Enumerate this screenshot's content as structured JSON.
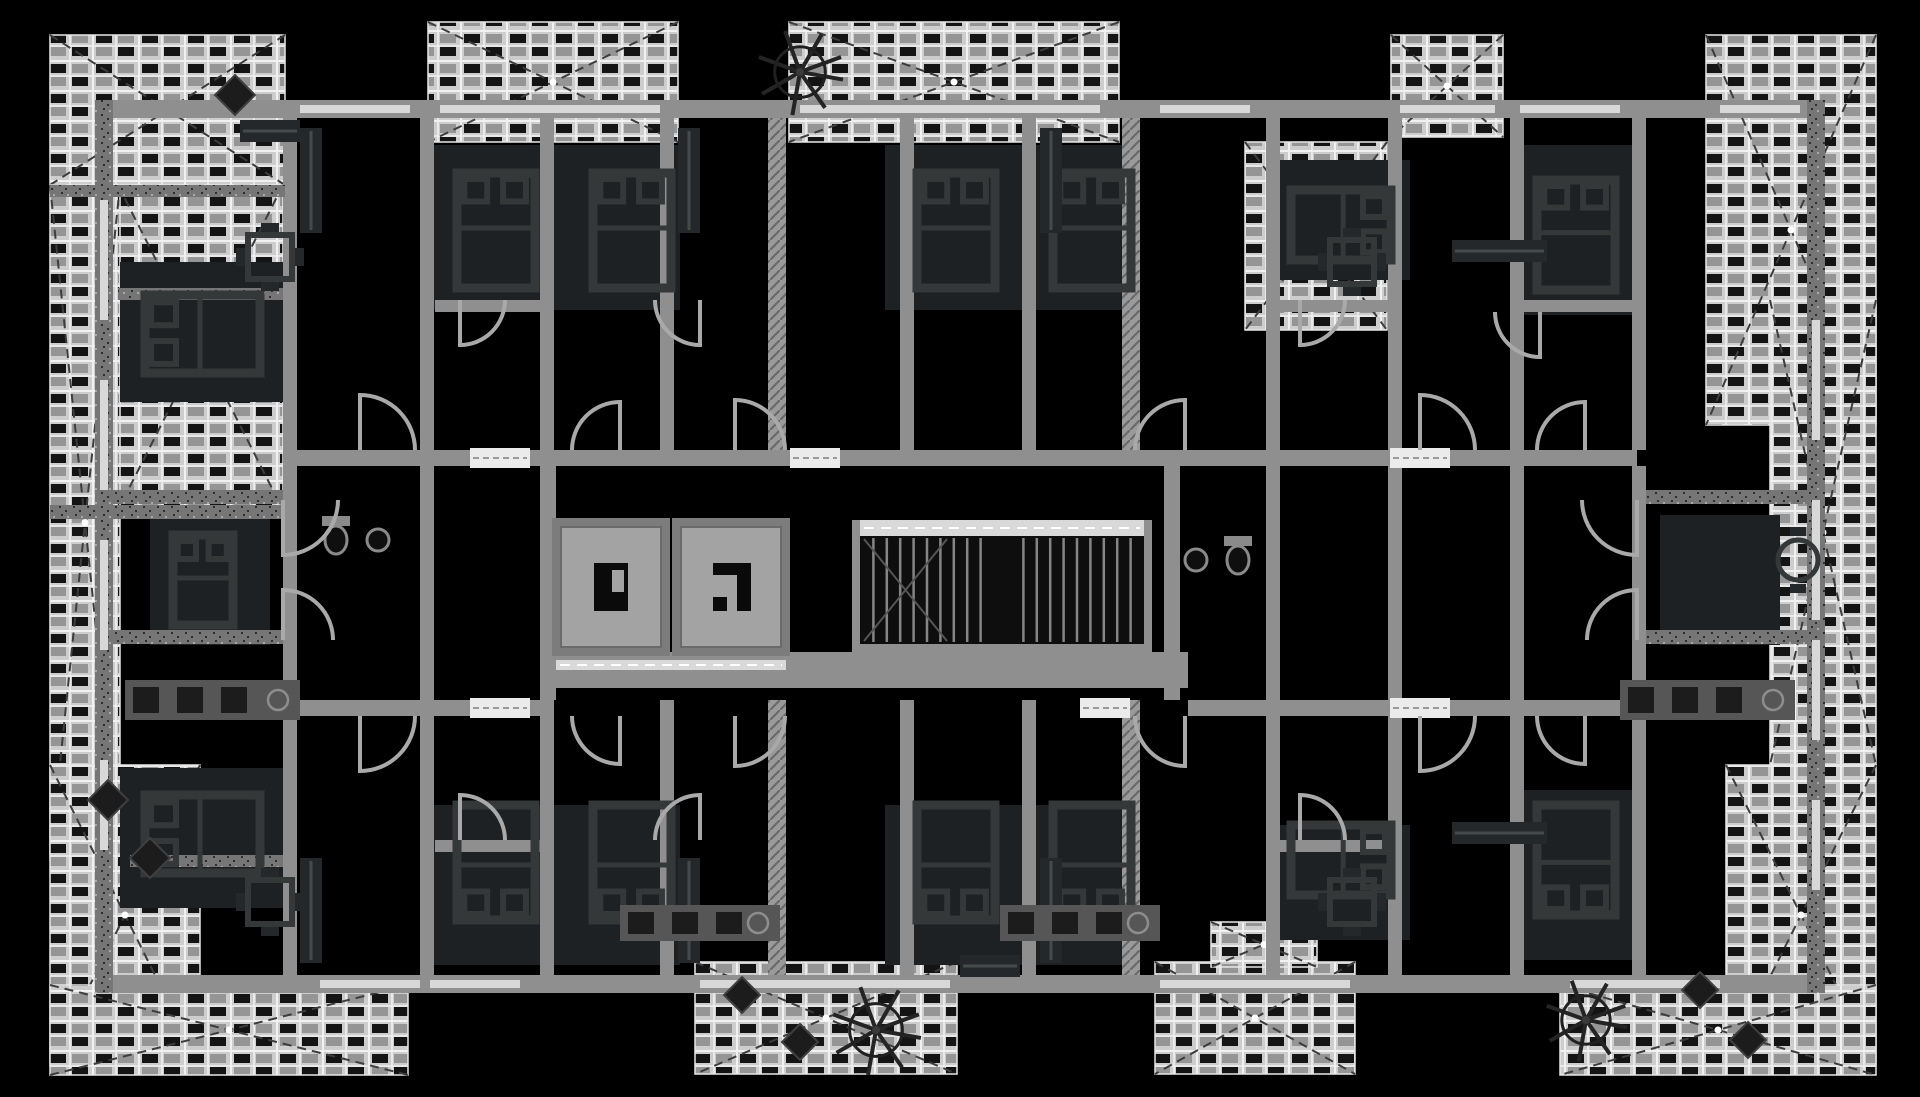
{
  "meta": {
    "type": "floor-plan",
    "style": "inverted-monochrome",
    "width": 1920,
    "height": 1097
  },
  "palette": {
    "background": "#000000",
    "wall": "#8f8f8f",
    "wall_dark": "#616161",
    "speckle_base": "#767676",
    "speckle_dot": "#2f2f2f",
    "hatch_base": "#9a9a9a",
    "hatch_line": "#6a6a6a",
    "balcony_field": "#cdcdcd",
    "balcony_grout": "#f1f1f1",
    "tile_dark": "#141414",
    "tile_mid": "#959595",
    "balcony_dash": "#3d3d3d",
    "furniture_line": "#343838",
    "furniture_fill": "#24282a",
    "room_mass": "#1d2123",
    "counter": "#565656",
    "appliance": "#1c1c1c",
    "door": "#a9a9a9",
    "window": "#d8d8d8",
    "threshold": "#ebebeb",
    "elevator_fill": "#a3a3a3",
    "elevator_wall": "#7c7c7c",
    "elevator_glyph": "#0a0a0a",
    "stair_bg": "#0e0e0e",
    "stair_tread": "#858585",
    "landing": "#d9d9d9",
    "landing_dash": "#ffffff",
    "tree": "#242424",
    "fixture": "#8a8a8a"
  },
  "balconies": [
    [
      50,
      35,
      235,
      150
    ],
    [
      118,
      185,
      165,
      325
    ],
    [
      50,
      185,
      70,
      675
    ],
    [
      428,
      22,
      250,
      120
    ],
    [
      789,
      22,
      330,
      120
    ],
    [
      1391,
      35,
      112,
      102
    ],
    [
      1245,
      142,
      142,
      188
    ],
    [
      1706,
      35,
      170,
      390
    ],
    [
      1770,
      300,
      106,
      465
    ],
    [
      50,
      765,
      150,
      300
    ],
    [
      50,
      985,
      358,
      90
    ],
    [
      695,
      962,
      262,
      112
    ],
    [
      1155,
      962,
      200,
      112
    ],
    [
      1211,
      922,
      106,
      45
    ],
    [
      1726,
      765,
      150,
      300
    ],
    [
      1560,
      985,
      316,
      90
    ]
  ],
  "walls": [
    [
      95,
      100,
      1730,
      18,
      "p"
    ],
    [
      95,
      975,
      1730,
      18,
      "p"
    ],
    [
      95,
      100,
      18,
      893,
      "s"
    ],
    [
      1807,
      100,
      18,
      893,
      "s"
    ],
    [
      283,
      450,
      1354,
      16,
      "p"
    ],
    [
      283,
      700,
      265,
      16,
      "p"
    ],
    [
      1188,
      700,
      449,
      16,
      "p"
    ],
    [
      548,
      652,
      640,
      36,
      "p"
    ],
    [
      540,
      466,
      16,
      234,
      "p"
    ],
    [
      1164,
      466,
      16,
      234,
      "p"
    ],
    [
      283,
      118,
      14,
      332,
      "p"
    ],
    [
      420,
      118,
      14,
      332,
      "p"
    ],
    [
      540,
      118,
      14,
      332,
      "p"
    ],
    [
      660,
      118,
      14,
      332,
      "p"
    ],
    [
      768,
      118,
      18,
      332,
      "h"
    ],
    [
      900,
      118,
      14,
      332,
      "p"
    ],
    [
      1022,
      118,
      14,
      332,
      "p"
    ],
    [
      1122,
      118,
      18,
      332,
      "h"
    ],
    [
      1266,
      118,
      14,
      332,
      "p"
    ],
    [
      1388,
      118,
      14,
      332,
      "p"
    ],
    [
      1510,
      118,
      14,
      332,
      "p"
    ],
    [
      1632,
      118,
      14,
      332,
      "p"
    ],
    [
      283,
      700,
      14,
      275,
      "p"
    ],
    [
      420,
      700,
      14,
      275,
      "p"
    ],
    [
      540,
      700,
      14,
      275,
      "p"
    ],
    [
      660,
      700,
      14,
      275,
      "p"
    ],
    [
      768,
      700,
      18,
      275,
      "h"
    ],
    [
      900,
      700,
      14,
      275,
      "p"
    ],
    [
      1022,
      700,
      14,
      275,
      "p"
    ],
    [
      1122,
      700,
      18,
      275,
      "h"
    ],
    [
      1266,
      700,
      14,
      275,
      "p"
    ],
    [
      1388,
      700,
      14,
      275,
      "p"
    ],
    [
      1510,
      700,
      14,
      275,
      "p"
    ],
    [
      1632,
      700,
      14,
      275,
      "p"
    ],
    [
      113,
      490,
      170,
      14,
      "s"
    ],
    [
      113,
      630,
      170,
      14,
      "s"
    ],
    [
      1637,
      490,
      170,
      14,
      "s"
    ],
    [
      1637,
      630,
      170,
      14,
      "s"
    ],
    [
      283,
      466,
      14,
      234,
      "p"
    ],
    [
      420,
      466,
      14,
      234,
      "p"
    ],
    [
      1266,
      466,
      14,
      234,
      "p"
    ],
    [
      1388,
      466,
      14,
      234,
      "p"
    ],
    [
      1510,
      466,
      14,
      234,
      "p"
    ],
    [
      1632,
      466,
      14,
      234,
      "p"
    ],
    [
      435,
      300,
      105,
      12,
      "p"
    ],
    [
      1280,
      300,
      108,
      12,
      "p"
    ],
    [
      1524,
      300,
      108,
      12,
      "p"
    ],
    [
      118,
      288,
      165,
      12,
      "s"
    ],
    [
      435,
      840,
      105,
      12,
      "p"
    ],
    [
      1280,
      840,
      108,
      12,
      "p"
    ],
    [
      130,
      855,
      153,
      12,
      "s"
    ],
    [
      50,
      185,
      235,
      12,
      "s"
    ],
    [
      50,
      505,
      235,
      14,
      "s"
    ]
  ],
  "windows": [
    [
      300,
      105,
      110,
      8
    ],
    [
      440,
      105,
      220,
      8
    ],
    [
      800,
      105,
      300,
      8
    ],
    [
      1160,
      105,
      90,
      8
    ],
    [
      1400,
      105,
      95,
      8
    ],
    [
      1520,
      105,
      100,
      8
    ],
    [
      1720,
      105,
      80,
      8
    ],
    [
      320,
      980,
      100,
      8
    ],
    [
      430,
      980,
      90,
      8
    ],
    [
      700,
      980,
      250,
      8
    ],
    [
      1160,
      980,
      190,
      8
    ],
    [
      1570,
      980,
      150,
      8
    ],
    [
      100,
      200,
      8,
      120
    ],
    [
      100,
      380,
      8,
      110
    ],
    [
      100,
      540,
      8,
      110
    ],
    [
      100,
      760,
      8,
      90
    ],
    [
      1812,
      320,
      8,
      120
    ],
    [
      1812,
      500,
      8,
      120
    ],
    [
      1812,
      640,
      8,
      100
    ],
    [
      1812,
      800,
      8,
      90
    ]
  ],
  "thresholds": [
    [
      470,
      448,
      60,
      20
    ],
    [
      1390,
      448,
      60,
      20
    ],
    [
      470,
      698,
      60,
      20
    ],
    [
      1390,
      698,
      60,
      20
    ],
    [
      790,
      448,
      50,
      20
    ],
    [
      1080,
      698,
      50,
      20
    ]
  ],
  "doors": [
    [
      360,
      450,
      55,
      1
    ],
    [
      620,
      450,
      48,
      4
    ],
    [
      735,
      450,
      50,
      1
    ],
    [
      1185,
      450,
      50,
      4
    ],
    [
      1420,
      450,
      55,
      1
    ],
    [
      1585,
      450,
      48,
      4
    ],
    [
      360,
      716,
      55,
      2
    ],
    [
      620,
      716,
      48,
      3
    ],
    [
      735,
      716,
      50,
      2
    ],
    [
      1185,
      716,
      50,
      3
    ],
    [
      1420,
      716,
      55,
      2
    ],
    [
      1585,
      716,
      48,
      3
    ],
    [
      460,
      300,
      45,
      2
    ],
    [
      700,
      300,
      45,
      3
    ],
    [
      1300,
      300,
      45,
      2
    ],
    [
      1540,
      312,
      45,
      3
    ],
    [
      460,
      840,
      45,
      1
    ],
    [
      700,
      840,
      45,
      4
    ],
    [
      1300,
      840,
      45,
      1
    ],
    [
      283,
      500,
      55,
      2
    ],
    [
      283,
      640,
      50,
      1
    ],
    [
      1637,
      500,
      55,
      3
    ],
    [
      1637,
      640,
      50,
      4
    ]
  ],
  "room_masses": [
    [
      425,
      145,
      255,
      165
    ],
    [
      885,
      145,
      255,
      165
    ],
    [
      120,
      262,
      170,
      140
    ],
    [
      1270,
      160,
      140,
      120
    ],
    [
      1518,
      145,
      125,
      170
    ],
    [
      425,
      805,
      255,
      160
    ],
    [
      885,
      805,
      255,
      160
    ],
    [
      120,
      768,
      170,
      140
    ],
    [
      1270,
      825,
      140,
      115
    ],
    [
      1518,
      790,
      125,
      170
    ],
    [
      150,
      515,
      120,
      130
    ],
    [
      1660,
      515,
      120,
      130
    ]
  ],
  "beds": [
    [
      140,
      290,
      125,
      88,
      "W"
    ],
    [
      452,
      168,
      88,
      125,
      "N"
    ],
    [
      588,
      168,
      88,
      125,
      "N"
    ],
    [
      912,
      168,
      88,
      125,
      "N"
    ],
    [
      1048,
      168,
      88,
      125,
      "N"
    ],
    [
      1286,
      185,
      110,
      80,
      "E"
    ],
    [
      1532,
      175,
      88,
      120,
      "N"
    ],
    [
      168,
      530,
      70,
      100,
      "N"
    ],
    [
      140,
      790,
      125,
      88,
      "W"
    ],
    [
      452,
      800,
      88,
      125,
      "S"
    ],
    [
      588,
      800,
      88,
      125,
      "S"
    ],
    [
      912,
      800,
      88,
      125,
      "S"
    ],
    [
      1048,
      800,
      88,
      125,
      "S"
    ],
    [
      1286,
      820,
      110,
      80,
      "E"
    ],
    [
      1532,
      800,
      88,
      120,
      "S"
    ]
  ],
  "wardrobes": [
    [
      300,
      128,
      22,
      105
    ],
    [
      678,
      128,
      22,
      105
    ],
    [
      1040,
      128,
      22,
      105
    ],
    [
      1452,
      240,
      95,
      22
    ],
    [
      240,
      120,
      60,
      22
    ],
    [
      300,
      858,
      22,
      105
    ],
    [
      678,
      858,
      22,
      105
    ],
    [
      1040,
      858,
      22,
      105
    ],
    [
      1452,
      822,
      95,
      22
    ],
    [
      960,
      955,
      60,
      22
    ]
  ],
  "counters": [
    [
      125,
      680,
      175,
      40
    ],
    [
      620,
      905,
      160,
      36
    ],
    [
      1000,
      905,
      160,
      36
    ],
    [
      1620,
      680,
      175,
      40
    ]
  ],
  "tables_square": [
    [
      248,
      235,
      44
    ],
    [
      1330,
      240,
      44
    ],
    [
      248,
      880,
      44
    ],
    [
      1330,
      880,
      44
    ]
  ],
  "tables_round": [
    [
      1798,
      560,
      20
    ]
  ],
  "diamonds": [
    [
      108,
      800,
      20
    ],
    [
      150,
      858,
      20
    ],
    [
      742,
      995,
      18
    ],
    [
      800,
      1042,
      18
    ],
    [
      1700,
      990,
      18
    ],
    [
      1748,
      1040,
      18
    ],
    [
      235,
      95,
      20
    ]
  ],
  "trees": [
    [
      800,
      72,
      46
    ],
    [
      876,
      1030,
      48
    ],
    [
      1586,
      1020,
      44
    ]
  ],
  "toilets": [
    [
      336,
      540
    ],
    [
      1238,
      560
    ]
  ],
  "sinks": [
    [
      378,
      540
    ],
    [
      1196,
      560
    ]
  ],
  "core": {
    "elevators": [
      {
        "x": 552,
        "y": 518,
        "w": 118,
        "h": 138,
        "glyph": "bracket"
      },
      {
        "x": 672,
        "y": 518,
        "w": 118,
        "h": 138,
        "glyph": "ell"
      }
    ],
    "lobby_strip": [
      556,
      660,
      230,
      10
    ],
    "stairs": {
      "x": 852,
      "y": 520,
      "w": 300,
      "h": 138,
      "flights": 2,
      "treads_per_flight": 9
    }
  }
}
